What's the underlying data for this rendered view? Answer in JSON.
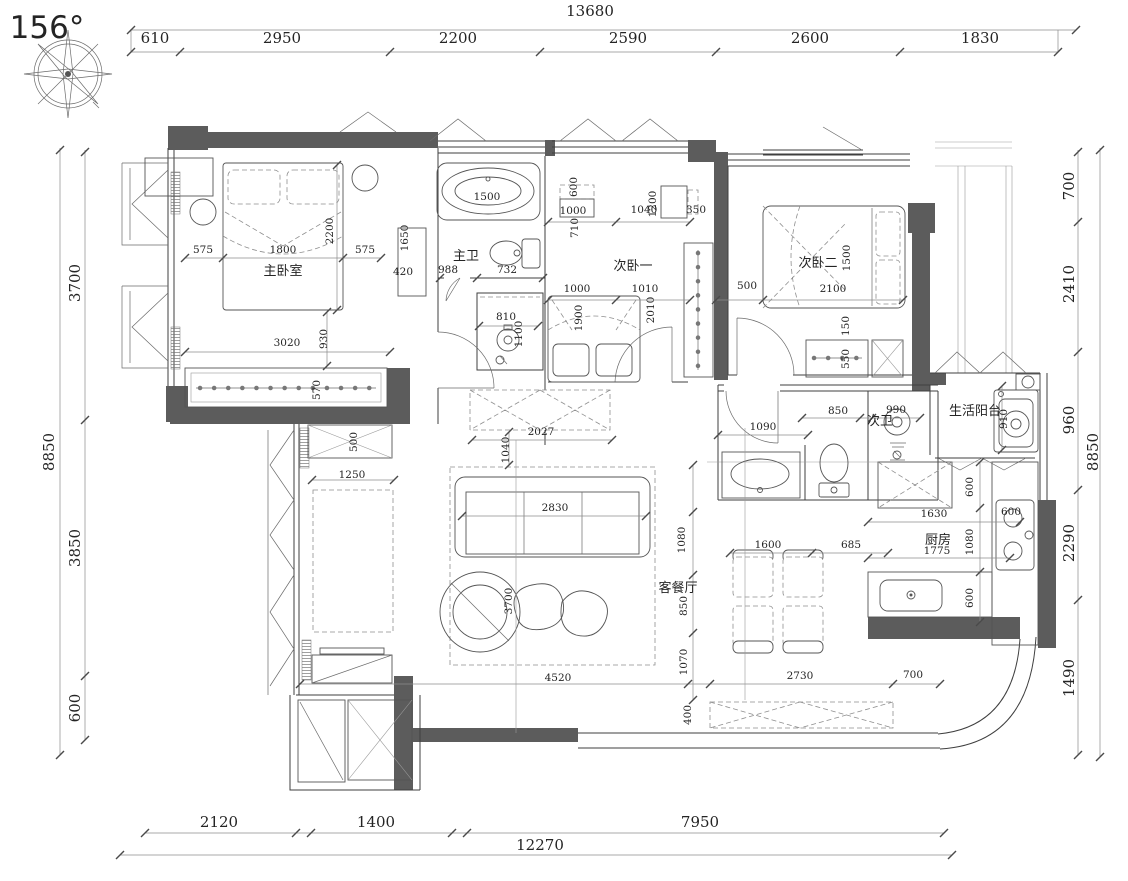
{
  "meta": {
    "drawing_type": "apartment floor plan",
    "compass_bearing": "156°"
  },
  "colors": {
    "wall_poche": "#5c5c5c",
    "line": "#3f3f3f",
    "dim_text": "#242424",
    "background": "#ffffff"
  },
  "rooms": [
    {
      "id": "master-bedroom",
      "label": "主卧室"
    },
    {
      "id": "master-bath",
      "label": "主卫"
    },
    {
      "id": "second-bedroom-1",
      "label": "次卧一"
    },
    {
      "id": "second-bedroom-2",
      "label": "次卧二"
    },
    {
      "id": "second-bath",
      "label": "次卫"
    },
    {
      "id": "service-balcony",
      "label": "生活阳台"
    },
    {
      "id": "kitchen",
      "label": "厨房"
    },
    {
      "id": "living-dining",
      "label": "客餐厅"
    }
  ],
  "dimensions_mm": {
    "top": {
      "overall": "13680",
      "segments": [
        "610",
        "2950",
        "2200",
        "2590",
        "2600",
        "1830"
      ]
    },
    "left": {
      "overall": "8850",
      "segments": [
        "3700",
        "3850",
        "600"
      ]
    },
    "right": {
      "overall": "8850",
      "segments": [
        "700",
        "2410",
        "960",
        "2290",
        "1490"
      ]
    },
    "bottom": {
      "overall": "12270",
      "segments": [
        "2120",
        "1400",
        "7950"
      ]
    }
  },
  "annotations": {
    "labels": [
      {
        "t": "156°",
        "x": 47,
        "y": 38,
        "c": "compass-lbl",
        "n": "compass-bearing"
      },
      {
        "t": "13680",
        "x": 590,
        "y": 16,
        "c": "dim-lg"
      },
      {
        "t": "610",
        "x": 155,
        "y": 43,
        "c": "dim-lg"
      },
      {
        "t": "2950",
        "x": 282,
        "y": 43,
        "c": "dim-lg"
      },
      {
        "t": "2200",
        "x": 458,
        "y": 43,
        "c": "dim-lg"
      },
      {
        "t": "2590",
        "x": 628,
        "y": 43,
        "c": "dim-lg"
      },
      {
        "t": "2600",
        "x": 810,
        "y": 43,
        "c": "dim-lg"
      },
      {
        "t": "1830",
        "x": 980,
        "y": 43,
        "c": "dim-lg"
      },
      {
        "t": "8850",
        "x": 54,
        "y": 452,
        "r": -90,
        "c": "dim-lg"
      },
      {
        "t": "3700",
        "x": 80,
        "y": 283,
        "r": -90,
        "c": "dim-lg"
      },
      {
        "t": "3850",
        "x": 80,
        "y": 548,
        "r": -90,
        "c": "dim-lg"
      },
      {
        "t": "600",
        "x": 80,
        "y": 708,
        "r": -90,
        "c": "dim-lg"
      },
      {
        "t": "700",
        "x": 1074,
        "y": 186,
        "r": -90,
        "c": "dim-lg"
      },
      {
        "t": "2410",
        "x": 1074,
        "y": 284,
        "r": -90,
        "c": "dim-lg"
      },
      {
        "t": "960",
        "x": 1074,
        "y": 420,
        "r": -90,
        "c": "dim-lg"
      },
      {
        "t": "8850",
        "x": 1098,
        "y": 452,
        "r": -90,
        "c": "dim-lg"
      },
      {
        "t": "2290",
        "x": 1074,
        "y": 543,
        "r": -90,
        "c": "dim-lg"
      },
      {
        "t": "1490",
        "x": 1074,
        "y": 678,
        "r": -90,
        "c": "dim-lg"
      },
      {
        "t": "2120",
        "x": 219,
        "y": 827,
        "c": "dim-lg"
      },
      {
        "t": "1400",
        "x": 376,
        "y": 827,
        "c": "dim-lg"
      },
      {
        "t": "7950",
        "x": 700,
        "y": 827,
        "c": "dim-lg"
      },
      {
        "t": "12270",
        "x": 540,
        "y": 850,
        "c": "dim-lg"
      },
      {
        "t": "575",
        "x": 203,
        "y": 253,
        "c": "dim-sm"
      },
      {
        "t": "1800",
        "x": 283,
        "y": 253,
        "c": "dim-sm"
      },
      {
        "t": "575",
        "x": 365,
        "y": 253,
        "c": "dim-sm"
      },
      {
        "t": "2200",
        "x": 333,
        "y": 231,
        "r": -90,
        "c": "dim-sm"
      },
      {
        "t": "3020",
        "x": 287,
        "y": 346,
        "c": "dim-sm"
      },
      {
        "t": "930",
        "x": 327,
        "y": 339,
        "r": -90,
        "c": "dim-sm"
      },
      {
        "t": "570",
        "x": 320,
        "y": 390,
        "r": -90,
        "c": "dim-sm"
      },
      {
        "t": "1650",
        "x": 408,
        "y": 238,
        "r": -90,
        "c": "dim-sm"
      },
      {
        "t": "420",
        "x": 403,
        "y": 275,
        "c": "dim-sm"
      },
      {
        "t": "1500",
        "x": 487,
        "y": 200,
        "c": "dim-sm"
      },
      {
        "t": "988",
        "x": 448,
        "y": 273,
        "c": "dim-sm"
      },
      {
        "t": "732",
        "x": 507,
        "y": 273,
        "c": "dim-sm"
      },
      {
        "t": "810",
        "x": 506,
        "y": 320,
        "c": "dim-sm"
      },
      {
        "t": "1100",
        "x": 522,
        "y": 334,
        "r": -90,
        "c": "dim-sm"
      },
      {
        "t": "600",
        "x": 577,
        "y": 187,
        "r": -90,
        "c": "dim-sm"
      },
      {
        "t": "1000",
        "x": 573,
        "y": 214,
        "c": "dim-sm"
      },
      {
        "t": "710",
        "x": 578,
        "y": 228,
        "r": -90,
        "c": "dim-sm"
      },
      {
        "t": "1040",
        "x": 644,
        "y": 213,
        "c": "dim-sm"
      },
      {
        "t": "1200",
        "x": 656,
        "y": 204,
        "r": -90,
        "c": "dim-sm"
      },
      {
        "t": "350",
        "x": 696,
        "y": 213,
        "c": "dim-sm"
      },
      {
        "t": "1000",
        "x": 577,
        "y": 292,
        "c": "dim-sm"
      },
      {
        "t": "1010",
        "x": 645,
        "y": 292,
        "c": "dim-sm"
      },
      {
        "t": "1900",
        "x": 582,
        "y": 318,
        "r": -90,
        "c": "dim-sm"
      },
      {
        "t": "2010",
        "x": 654,
        "y": 310,
        "r": -90,
        "c": "dim-sm"
      },
      {
        "t": "500",
        "x": 747,
        "y": 289,
        "c": "dim-sm"
      },
      {
        "t": "2100",
        "x": 833,
        "y": 292,
        "c": "dim-sm"
      },
      {
        "t": "1500",
        "x": 850,
        "y": 258,
        "r": -90,
        "c": "dim-sm"
      },
      {
        "t": "150",
        "x": 849,
        "y": 326,
        "r": -90,
        "c": "dim-sm"
      },
      {
        "t": "550",
        "x": 849,
        "y": 359,
        "r": -90,
        "c": "dim-sm"
      },
      {
        "t": "2027",
        "x": 541,
        "y": 435,
        "c": "dim-sm"
      },
      {
        "t": "1040",
        "x": 509,
        "y": 450,
        "r": -90,
        "c": "dim-sm"
      },
      {
        "t": "500",
        "x": 357,
        "y": 442,
        "r": -90,
        "c": "dim-sm"
      },
      {
        "t": "1250",
        "x": 352,
        "y": 478,
        "c": "dim-sm"
      },
      {
        "t": "1090",
        "x": 763,
        "y": 430,
        "c": "dim-sm"
      },
      {
        "t": "850",
        "x": 838,
        "y": 414,
        "c": "dim-sm"
      },
      {
        "t": "990",
        "x": 896,
        "y": 413,
        "c": "dim-sm"
      },
      {
        "t": "2830",
        "x": 555,
        "y": 511,
        "c": "dim-sm"
      },
      {
        "t": "3700",
        "x": 512,
        "y": 601,
        "r": -90,
        "c": "dim-sm"
      },
      {
        "t": "4520",
        "x": 558,
        "y": 681,
        "c": "dim-sm"
      },
      {
        "t": "1600",
        "x": 768,
        "y": 548,
        "c": "dim-sm"
      },
      {
        "t": "685",
        "x": 851,
        "y": 548,
        "c": "dim-sm"
      },
      {
        "t": "1080",
        "x": 685,
        "y": 540,
        "r": -90,
        "c": "dim-sm"
      },
      {
        "t": "850",
        "x": 687,
        "y": 606,
        "r": -90,
        "c": "dim-sm"
      },
      {
        "t": "1070",
        "x": 687,
        "y": 662,
        "r": -90,
        "c": "dim-sm"
      },
      {
        "t": "2730",
        "x": 800,
        "y": 679,
        "c": "dim-sm"
      },
      {
        "t": "700",
        "x": 913,
        "y": 678,
        "c": "dim-sm"
      },
      {
        "t": "400",
        "x": 691,
        "y": 715,
        "r": -90,
        "c": "dim-sm"
      },
      {
        "t": "600",
        "x": 973,
        "y": 487,
        "r": -90,
        "c": "dim-sm"
      },
      {
        "t": "1630",
        "x": 934,
        "y": 517,
        "c": "dim-sm"
      },
      {
        "t": "1080",
        "x": 973,
        "y": 542,
        "r": -90,
        "c": "dim-sm"
      },
      {
        "t": "600",
        "x": 973,
        "y": 598,
        "r": -90,
        "c": "dim-sm"
      },
      {
        "t": "600",
        "x": 1011,
        "y": 515,
        "c": "dim-sm"
      },
      {
        "t": "1775",
        "x": 937,
        "y": 554,
        "c": "dim-sm"
      },
      {
        "t": "910",
        "x": 1007,
        "y": 419,
        "r": -90,
        "c": "dim-sm"
      },
      {
        "t": "主卧室",
        "x": 283,
        "y": 275,
        "c": "room",
        "n": "room-label-master-bedroom"
      },
      {
        "t": "主卫",
        "x": 466,
        "y": 260,
        "c": "room",
        "n": "room-label-master-bath"
      },
      {
        "t": "次卧一",
        "x": 633,
        "y": 270,
        "c": "room",
        "n": "room-label-second-bedroom-1"
      },
      {
        "t": "次卧二",
        "x": 818,
        "y": 267,
        "c": "room",
        "n": "room-label-second-bedroom-2"
      },
      {
        "t": "生活阳台",
        "x": 975,
        "y": 415,
        "c": "room",
        "fs": 12,
        "n": "room-label-service-balcony"
      },
      {
        "t": "次卫",
        "x": 880,
        "y": 425,
        "c": "room",
        "fs": 11,
        "n": "room-label-second-bath"
      },
      {
        "t": "厨房",
        "x": 938,
        "y": 544,
        "c": "room",
        "n": "room-label-kitchen"
      },
      {
        "t": "客餐厅",
        "x": 678,
        "y": 592,
        "c": "room",
        "fs": 12,
        "n": "room-label-living-dining"
      }
    ],
    "ticks": [
      [
        131,
        30
      ],
      [
        1076,
        30
      ],
      [
        131,
        52
      ],
      [
        180,
        52
      ],
      [
        390,
        52
      ],
      [
        540,
        52
      ],
      [
        716,
        52
      ],
      [
        900,
        52
      ],
      [
        1058,
        52
      ],
      [
        60,
        150
      ],
      [
        60,
        755
      ],
      [
        85,
        152
      ],
      [
        85,
        420
      ],
      [
        85,
        676
      ],
      [
        85,
        740
      ],
      [
        1078,
        152
      ],
      [
        1078,
        222
      ],
      [
        1078,
        352
      ],
      [
        1078,
        490
      ],
      [
        1078,
        600
      ],
      [
        1078,
        755
      ],
      [
        1100,
        150
      ],
      [
        1100,
        757
      ],
      [
        145,
        833
      ],
      [
        296,
        833
      ],
      [
        311,
        833
      ],
      [
        452,
        833
      ],
      [
        467,
        833
      ],
      [
        944,
        833
      ],
      [
        120,
        855
      ],
      [
        952,
        855
      ],
      [
        185,
        258
      ],
      [
        223,
        258
      ],
      [
        343,
        258
      ],
      [
        381,
        258
      ],
      [
        185,
        352
      ],
      [
        390,
        352
      ],
      [
        337,
        165
      ],
      [
        337,
        310
      ],
      [
        327,
        312
      ],
      [
        327,
        366
      ],
      [
        472,
        440
      ],
      [
        612,
        440
      ],
      [
        509,
        432
      ],
      [
        509,
        465
      ],
      [
        300,
        684
      ],
      [
        688,
        684
      ],
      [
        710,
        684
      ],
      [
        893,
        684
      ],
      [
        940,
        684
      ],
      [
        730,
        553
      ],
      [
        812,
        553
      ],
      [
        888,
        553
      ],
      [
        718,
        435
      ],
      [
        808,
        435
      ],
      [
        868,
        522
      ],
      [
        1020,
        522
      ],
      [
        868,
        558
      ],
      [
        1010,
        558
      ],
      [
        980,
        462
      ],
      [
        980,
        508
      ],
      [
        980,
        572
      ],
      [
        980,
        622
      ],
      [
        693,
        465
      ],
      [
        693,
        512
      ],
      [
        693,
        575
      ],
      [
        693,
        633
      ],
      [
        693,
        700
      ],
      [
        312,
        480
      ],
      [
        394,
        480
      ],
      [
        462,
        516
      ],
      [
        646,
        516
      ],
      [
        1002,
        386
      ],
      [
        1002,
        450
      ],
      [
        548,
        222
      ],
      [
        616,
        222
      ],
      [
        690,
        222
      ],
      [
        548,
        300
      ],
      [
        616,
        300
      ],
      [
        690,
        300
      ],
      [
        716,
        300
      ],
      [
        763,
        300
      ],
      [
        903,
        300
      ],
      [
        440,
        278
      ],
      [
        477,
        278
      ],
      [
        543,
        278
      ],
      [
        479,
        326
      ],
      [
        538,
        326
      ],
      [
        802,
        418
      ],
      [
        860,
        418
      ],
      [
        872,
        418
      ],
      [
        920,
        418
      ]
    ]
  }
}
